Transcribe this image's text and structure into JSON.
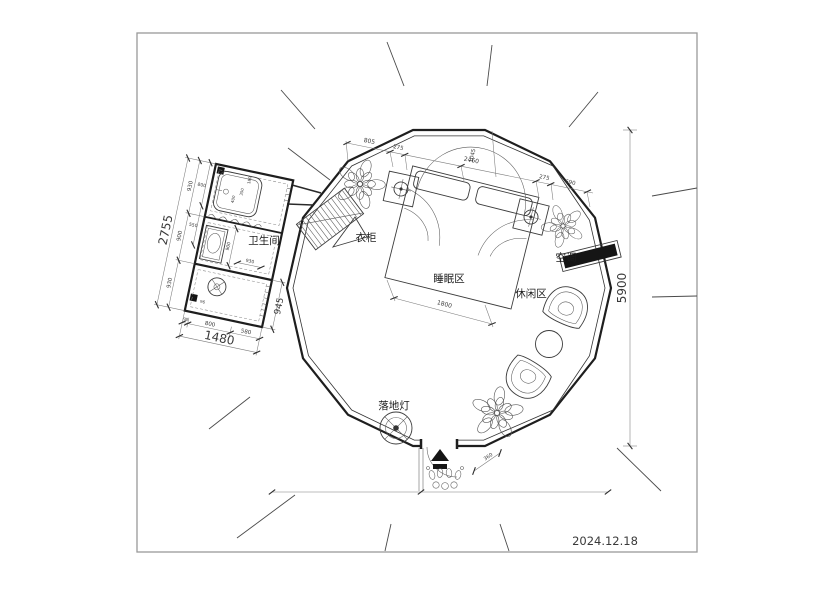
{
  "date": "2024.12.18",
  "rooms": {
    "bathroom": "卫生间",
    "sleeping_area": "睡眠区",
    "leisure_area": "休闲区"
  },
  "furniture": {
    "wardrobe": "衣柜",
    "air_conditioner": "空调",
    "floor_lamp": "落地灯"
  },
  "dimensions": {
    "overall_diameter": "5900",
    "top_chain": [
      "805",
      "275",
      "2460",
      "1045",
      "275",
      "690"
    ],
    "bed_width": "1800",
    "entrance_width": "360",
    "bathroom": {
      "total_width": "1480",
      "total_height": "2755",
      "left_chain": [
        "930",
        "900",
        "930"
      ],
      "bottom_chain": [
        "98",
        "800",
        "580"
      ],
      "right_side": "945",
      "inner": [
        "800",
        "550",
        "900",
        "930",
        "96",
        "180",
        "350",
        "400"
      ]
    }
  }
}
